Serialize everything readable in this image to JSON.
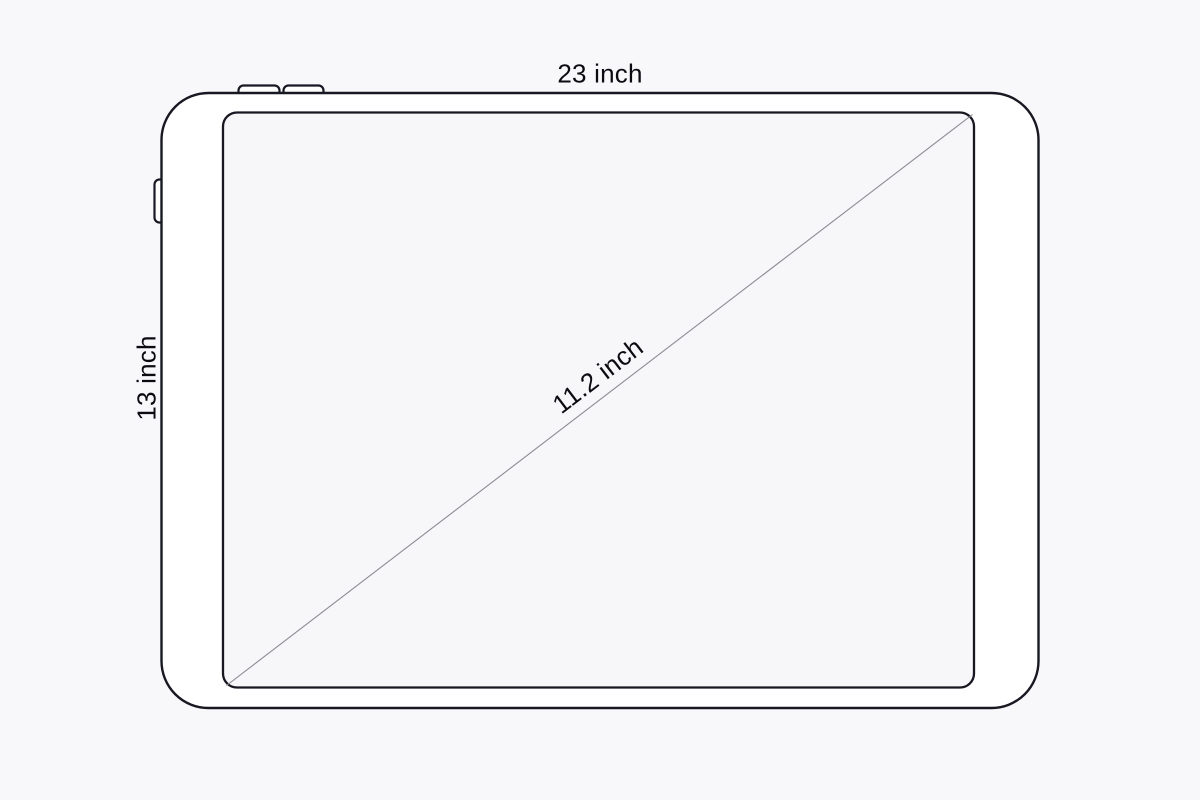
{
  "diagram": {
    "description": "tablet-dimensions-outline",
    "labels": {
      "width": "23 inch",
      "height": "13 inch",
      "diagonal": "11.2 inch"
    },
    "colors": {
      "background": "#f8f8fa",
      "body_fill": "#ffffff",
      "screen_fill": "#f7f7f9",
      "outline": "#181822",
      "diagonal_line": "#8b8b93",
      "label_text": "#0b0b11"
    }
  }
}
